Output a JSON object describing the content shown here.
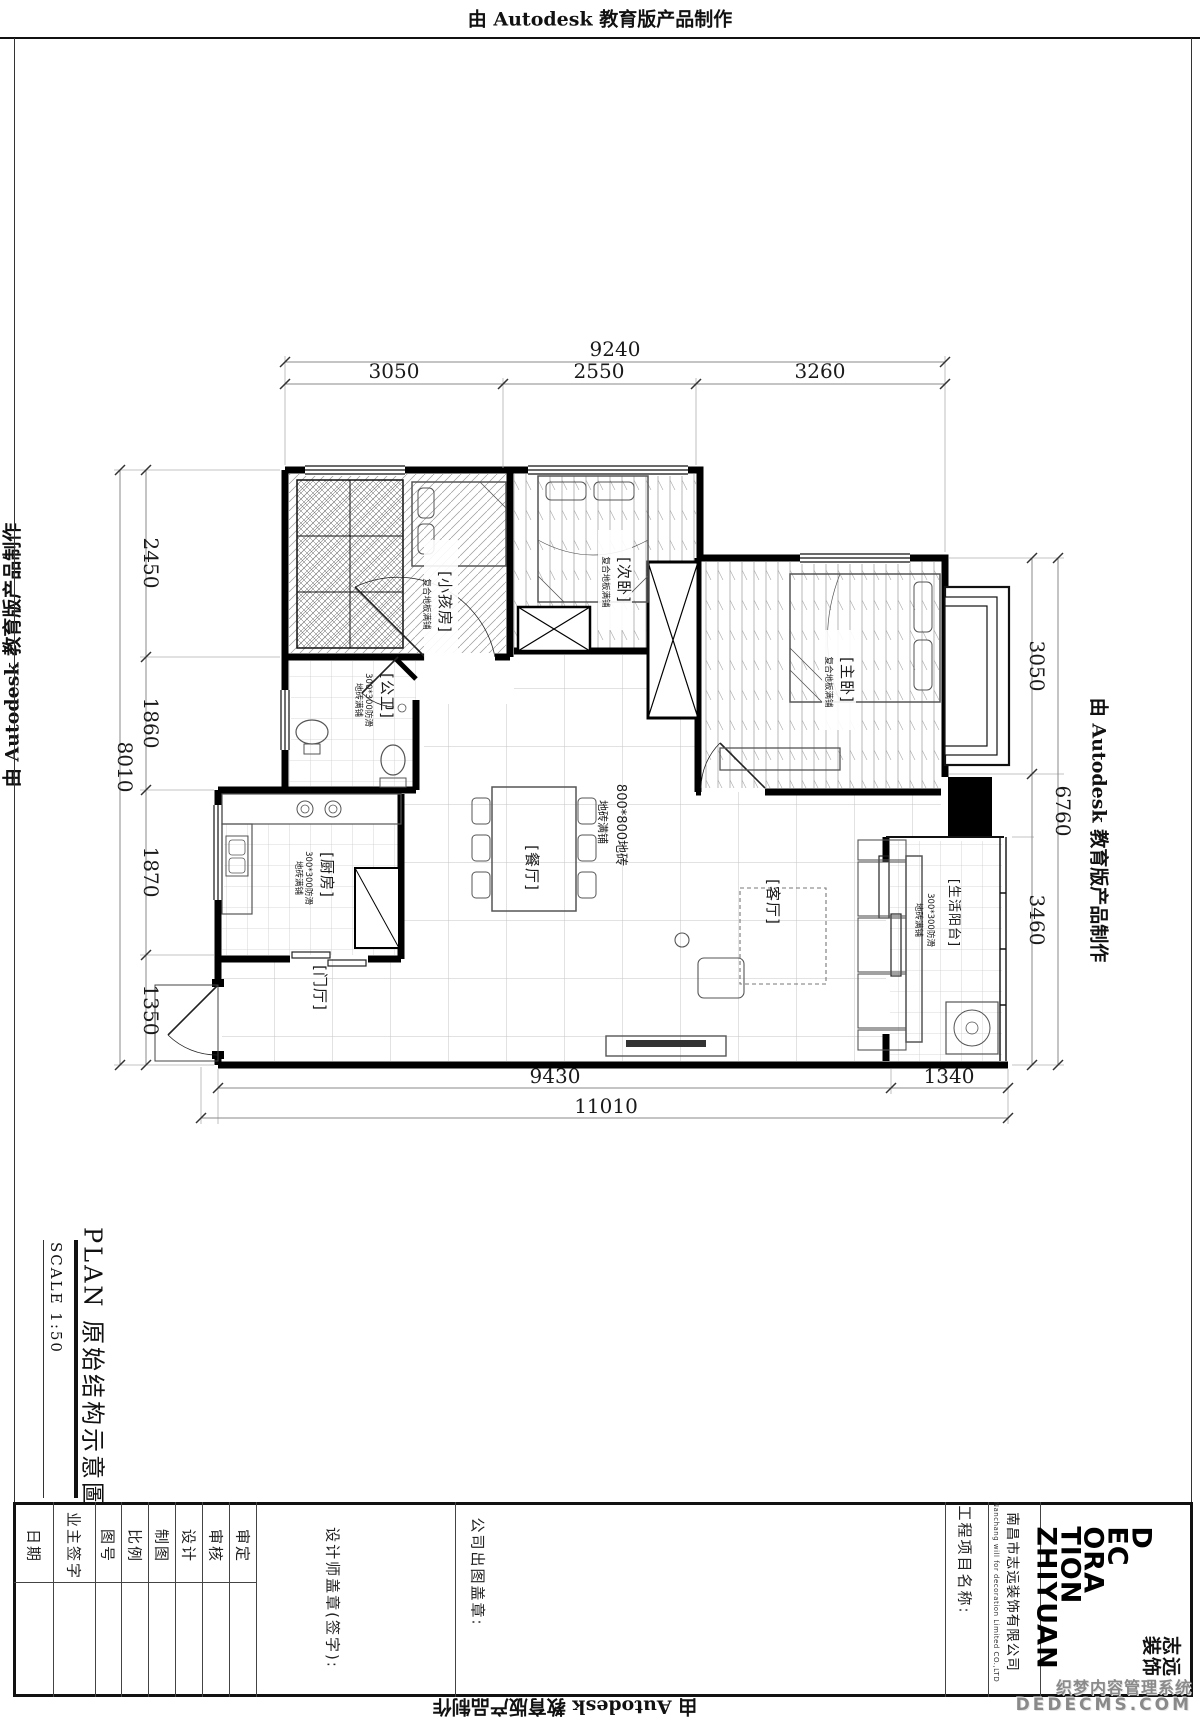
{
  "sheet": {
    "autodesk_stamp": "由 Autodesk 教育版产品制作"
  },
  "title_block": {
    "title": "PLAN  原始结构示意圖",
    "scale": "SCALE  1:50"
  },
  "plan": {
    "rooms": [
      {
        "id": "kids-room",
        "label": "[小孩房]",
        "floor": "复合地板满铺"
      },
      {
        "id": "second-bedroom",
        "label": "[次卧]",
        "floor": "复合地板满铺"
      },
      {
        "id": "master-bedroom",
        "label": "[主卧]",
        "floor": "复合地板满铺"
      },
      {
        "id": "bathroom",
        "label": "[公卫]",
        "floor": "300*300防滑",
        "floor2": "地砖满铺"
      },
      {
        "id": "kitchen",
        "label": "[厨房]",
        "floor": "300*300防滑",
        "floor2": "地砖满铺"
      },
      {
        "id": "dining",
        "label": "[餐厅]"
      },
      {
        "id": "living",
        "label": "[客厅]"
      },
      {
        "id": "balcony",
        "label": "[生活阳台]",
        "floor": "300*300防滑",
        "floor2": "地砖满铺"
      },
      {
        "id": "foyer",
        "label": "[门厅]"
      }
    ],
    "floor_note": {
      "spec": "800*800地砖",
      "lay": "地砖满铺"
    },
    "dims": {
      "top": {
        "overall": "9240",
        "segments": [
          "3050",
          "2550",
          "3260"
        ]
      },
      "left": {
        "overall": "8010",
        "segments": [
          "2450",
          "1860",
          "1870",
          "1350"
        ]
      },
      "right": {
        "overall": "6760",
        "segments": [
          "3050",
          "3460"
        ]
      },
      "bottom": {
        "overall": "11010",
        "segments": [
          "9430",
          "1340"
        ]
      }
    }
  },
  "title_table": {
    "fields": [
      {
        "label": "日期"
      },
      {
        "label": "业主签字"
      },
      {
        "label": "图号"
      },
      {
        "label": "比例"
      },
      {
        "label": "制图"
      },
      {
        "label": "设计"
      },
      {
        "label": "审核"
      },
      {
        "label": "审定"
      }
    ],
    "designer_stamp_label": "设计师盖章(签字):",
    "company_stamp_label": "公司出图盖章:",
    "project_name_label": "工程项目名称:",
    "company_name": "南昌市志远装饰有限公司",
    "company_name_en": "Nanchang will for decoration Limited CO.,LTD",
    "logo_lines": [
      "D",
      "EC",
      "ORA",
      "TION",
      "ZHIYUAN"
    ],
    "logo_seal_lines": [
      "志远",
      "装饰"
    ]
  },
  "watermark": {
    "line1": "织梦内容管理系统",
    "line2": "DEDECMS.COM"
  }
}
